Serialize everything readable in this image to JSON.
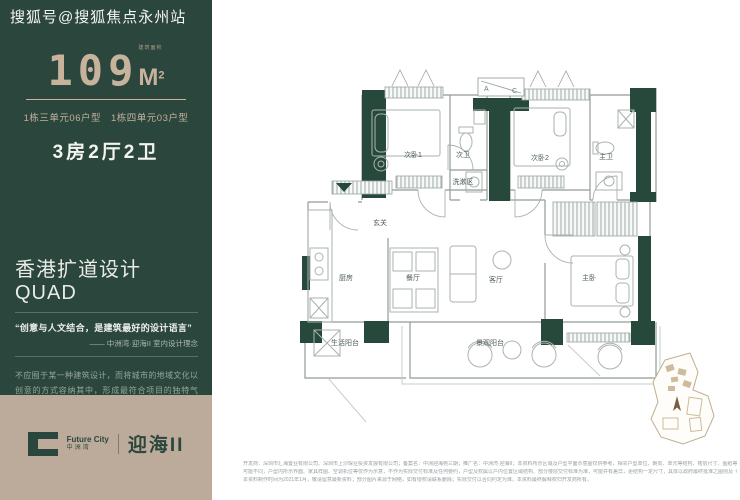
{
  "watermark": "搜狐号@搜狐焦点永州站",
  "panel": {
    "area": {
      "value": "109",
      "unit": "M",
      "sup": "2",
      "note": "建筑面积"
    },
    "unit_a": "1栋三单元06户型",
    "unit_b": "1栋四单元03户型",
    "layout": "3房2厅2卫",
    "design_title": "香港扩道设计QUAD",
    "quote": "“创意与人文结合，是建筑最好的设计语言”",
    "quote_source": "—— 中洲湾·迎海II 室内设计理念",
    "description": "不应囿于某一种建筑设计，而将城市的地域文化以创意的方式容纳其中，形成最符合项目的独特气质，将高端品质作为生活的基底，提升人物的生活品质，重塑城市的人居标准。",
    "colors": {
      "green": "#2b463d",
      "tan": "#bcab9a",
      "beige_text": "#c7b39b"
    }
  },
  "logo": {
    "brand_en": "Future City",
    "brand_cn": "中洲湾",
    "product": "迎海II"
  },
  "floor_plan": {
    "rooms": [
      "次卧1",
      "次卫",
      "洗漱区",
      "次卧2",
      "主卫",
      "玄关",
      "厨房",
      "餐厅",
      "客厅",
      "主卧",
      "生活阳台",
      "景观阳台"
    ],
    "ac_a": "A",
    "ac_c": "C",
    "wall_color": "#26493c",
    "line_color": "#8f9b97"
  },
  "disclaimer": {
    "line1": "开发商：深圳市汇海置业有限公司、深圳市上沙琛业投资发展有限公司；备案名：中洲迎海苑三期；推广名：中洲湾·迎海II；本资料所示区域及户型平面示意图仅供参考，相邻户型单位、朝向、单元等结构、楼层尺寸、图纸等",
    "line2": "可能不同，户型内所示界面、家具样图、空调机位等仅作为示意，不作为实际交付标准及任何要约，户型及权属以户内位置区域结构、部分楼层交付标准为准，可能并有差异，更结构一定尺寸，具体以政府最终批准之图则及《商品房买卖合同》约定为准。",
    "line3": "本资料制作时间为2021年1月，敬请留意最新资料；部分图片来源于网络，如有侵权请联系删除；实际交付以合同约定为准，本资料最终解释权归开发商所有。"
  }
}
